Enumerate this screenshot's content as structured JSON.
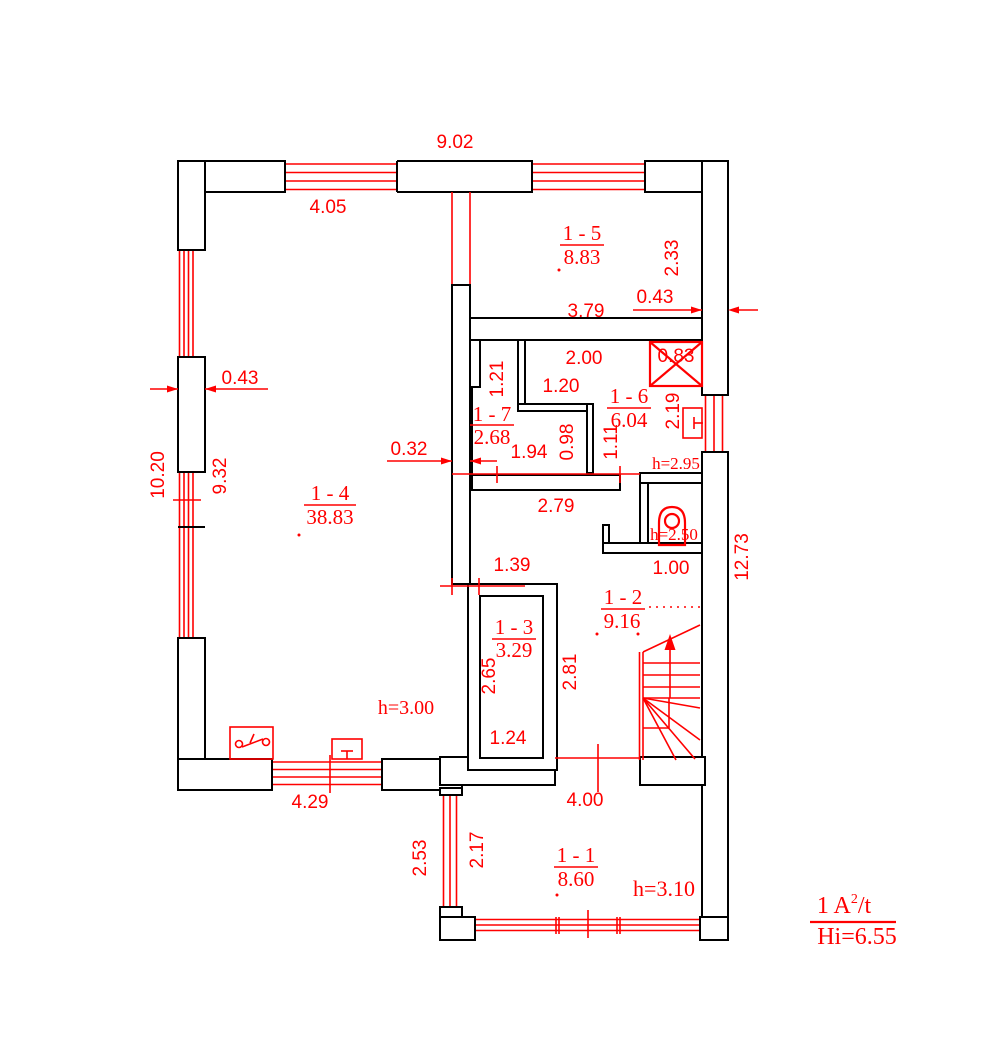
{
  "title": "First floor plan",
  "colors": {
    "accent": "#ff0000",
    "wall": "#000000",
    "background": "#ffffff"
  },
  "rooms": [
    {
      "id": "1 - 1",
      "area": "8.60"
    },
    {
      "id": "1 - 2",
      "area": "9.16"
    },
    {
      "id": "1 - 3",
      "area": "3.29"
    },
    {
      "id": "1 - 4",
      "area": "38.83"
    },
    {
      "id": "1 - 5",
      "area": "8.83"
    },
    {
      "id": "1 - 6",
      "area": "6.04"
    },
    {
      "id": "1 - 7",
      "area": "2.68"
    }
  ],
  "heights": {
    "room14": "h=3.00",
    "room16": "h=2.95",
    "wc": "h=2.50",
    "room11": "h=3.10"
  },
  "dims": {
    "building_width": "9.02",
    "room14_width": "4.05",
    "room15_width": "3.79",
    "room15_depth": "2.33",
    "wall_right": "0.43",
    "wall_left": "0.43",
    "partition": "0.32",
    "room16_niche_width": "2.00",
    "room16_niche_depth": "1.20",
    "shaft": "0.83",
    "niche_depth": "1.21",
    "room16_depth": "2.19",
    "room17_width": "1.94",
    "room17_depth": "0.98",
    "room16_lower": "1.11",
    "hall_width": "2.79",
    "wc_width": "1.00",
    "hall_passage": "1.39",
    "room13_depth": "2.65",
    "hall_depth": "2.81",
    "room13_width": "1.24",
    "room14_bottom": "4.29",
    "porch_depth": "2.53",
    "room11_depth": "2.17",
    "room11_width": "4.00",
    "left_outer": "10.20",
    "left_inner": "9.32",
    "right_outer": "12.73"
  },
  "legend": {
    "prefix": "1 A",
    "sup": "2",
    "suffix": "/t",
    "total": "Hi=6.55"
  },
  "icons": {
    "shaft": "ventilation-shaft",
    "toilet": "toilet",
    "switch": "electrical-switch-symbol",
    "radiator": "radiator-symbol",
    "stairs": "staircase-up-arrow"
  }
}
